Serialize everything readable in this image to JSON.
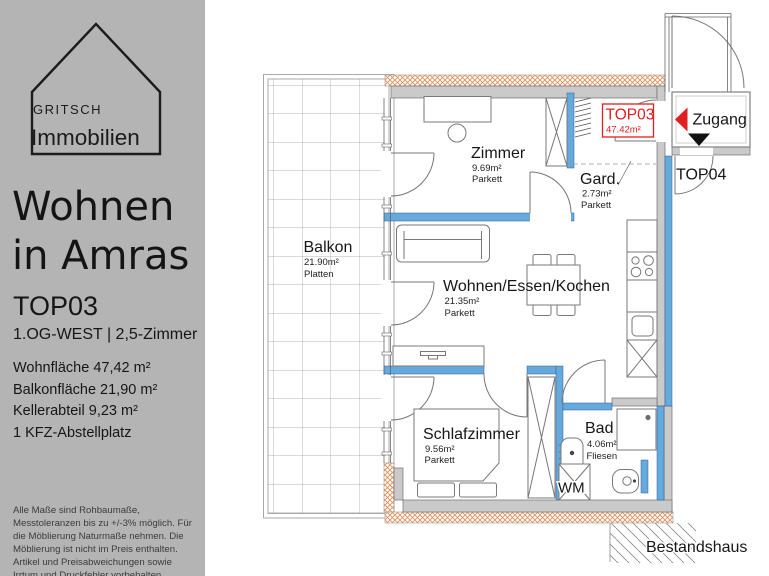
{
  "sidebar": {
    "logo": {
      "line1": "GRITSCH",
      "line2": "Immobilien"
    },
    "title_line1": "Wohnen",
    "title_line2": "in Amras",
    "unit": "TOP03",
    "unit_sub": "1.OG-WEST | 2,5-Zimmer",
    "details": [
      "Wohnfläche 47,42 m²",
      "Balkonfläche 21,90 m²",
      "Kellerabteil 9,23 m²",
      "1 KFZ-Abstellplatz"
    ],
    "disclaimer": "Alle Maße sind Rohbaumaße, Messtoleranzen bis zu +/-3% möglich. Für die Möblierung Naturmaße nehmen. Die Möblierung ist nicht im Preis enthalten. Artikel und Preisabweichungen sowie Irrtum und Druckfehler vorbehalten."
  },
  "plan": {
    "unit_badge": {
      "label": "TOP03",
      "area": "47.42m²"
    },
    "rooms": {
      "balkon": {
        "name": "Balkon",
        "area": "21.90m²",
        "floor": "Platten"
      },
      "zimmer": {
        "name": "Zimmer",
        "area": "9.69m²",
        "floor": "Parkett"
      },
      "gard": {
        "name": "Gard.",
        "area": "2.73m²",
        "floor": "Parkett"
      },
      "wohnen": {
        "name": "Wohnen/Essen/Kochen",
        "area": "21.35m²",
        "floor": "Parkett"
      },
      "schlaf": {
        "name": "Schlafzimmer",
        "area": "9.56m²",
        "floor": "Parkett"
      },
      "bad": {
        "name": "Bad",
        "area": "4.06m²",
        "floor": "Fliesen"
      }
    },
    "zugang_label": "Zugang",
    "top04_label": "TOP04",
    "wm_label": "WM",
    "bestandshaus_label": "Bestandshaus"
  },
  "colors": {
    "sidebar": "#b4b4b4",
    "wall": "#cacaca",
    "window": "#66a9dd",
    "insulation": "#e0905a",
    "accent": "#e02020"
  }
}
